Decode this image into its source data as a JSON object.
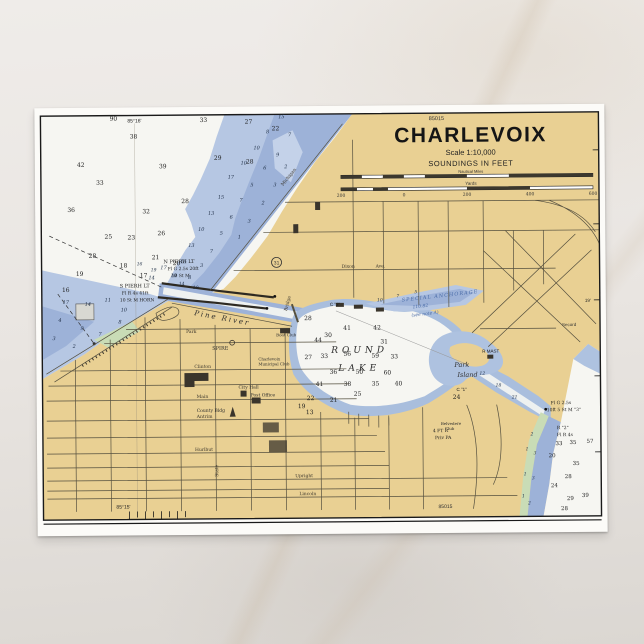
{
  "colors": {
    "land": "#e9d093",
    "water_light": "#b6c7e3",
    "water_mid": "#9db2d8",
    "water_deep_white": "#f6f6f2",
    "marsh_green": "#c9dcb6",
    "line": "#55503f",
    "anchorage_text": "#4a6ca8",
    "card": "#fcfbf8"
  },
  "title_block": {
    "chart_no": "85015",
    "title": "CHARLEVOIX",
    "scale": "Scale 1:10,000",
    "soundings": "SOUNDINGS IN FEET",
    "miles_label": "Nautical Miles",
    "yards_label": "Yards",
    "yards_ticks": [
      "200",
      "0",
      "200",
      "400",
      "600"
    ]
  },
  "borders": {
    "lon_top": "85°16'",
    "lon_bottom": "85°15'",
    "lat_right": "19'",
    "chart_no_bottom": "85015"
  },
  "features": {
    "round_lake_1": "ROUND",
    "round_lake_2": "LAKE",
    "pine_river": "Pine  River",
    "park_island_1": "Park",
    "park_island_2": "Island",
    "anchorage_1": "SPECIAL ANCHORAGE",
    "anchorage_2": "110.82",
    "anchorage_3": "(see note A)",
    "secord": "Secord"
  },
  "lights": {
    "n_pier_1": "N PIERH LT",
    "n_pier_2": "Fl G 2.5s 20ft",
    "n_pier_3": "10 St M",
    "s_pier_1": "S PIERH LT",
    "s_pier_2": "Fl R 4s 41ft",
    "s_pier_3": "10 St M HORN",
    "ch3_1": "Fl G 2.5s",
    "ch3_2": "10ft 5 St M \"3\"",
    "buoy2_1": "R \"2\"",
    "buoy2_2": "Fl R 4s",
    "priv_1": "4 FT R",
    "priv_2": "Priv PA",
    "r_mast": "R MAST",
    "c3": "C \"3\"",
    "c1": "C \"1\"",
    "us31": "31"
  },
  "places": {
    "spire": "SPIRE",
    "city_hall": "City Hall",
    "post_office": "Post Office",
    "county_bldg": "County Bldg",
    "municipal_1": "Charlevoix",
    "municipal_2": "Municipal Club",
    "boat_club": "Boat Club",
    "belvedere_1": "Belvedere",
    "belvedere_2": "Club"
  },
  "streets": {
    "dixon": "Dixon",
    "dixon_ave": "Ave.",
    "clinton": "Clinton",
    "main": "Main",
    "antrim": "Antrim",
    "hurlbut": "Hurlbut",
    "upright": "Upright",
    "lincoln": "Lincoln",
    "michigan": "Michigan",
    "state": "State",
    "bridge": "Bridge",
    "park": "Park"
  },
  "soundings": {
    "lm": {
      "size": 6,
      "fill": "#1e1e1e",
      "italic": false,
      "pts": [
        [
          79,
          13,
          "90"
        ],
        [
          169,
          15,
          "33"
        ],
        [
          214,
          17,
          "27"
        ],
        [
          241,
          24,
          "22"
        ],
        [
          99,
          31,
          "38"
        ],
        [
          46,
          59,
          "42"
        ],
        [
          128,
          61,
          "39"
        ],
        [
          183,
          53,
          "29"
        ],
        [
          215,
          57,
          "28"
        ],
        [
          65,
          77,
          "33"
        ],
        [
          36,
          104,
          "36"
        ],
        [
          111,
          106,
          "32"
        ],
        [
          150,
          96,
          "28"
        ],
        [
          73,
          131,
          "25"
        ],
        [
          96,
          132,
          "23"
        ],
        [
          126,
          128,
          "26"
        ],
        [
          57,
          150,
          "28"
        ],
        [
          120,
          152,
          "21"
        ],
        [
          141,
          158,
          "20"
        ],
        [
          44,
          168,
          "19"
        ],
        [
          88,
          160,
          "18"
        ],
        [
          108,
          170,
          "17"
        ],
        [
          30,
          184,
          "16"
        ]
      ]
    },
    "band": {
      "size": 5,
      "fill": "#1d2d45",
      "italic": true,
      "pts": [
        [
          247,
          12,
          "15"
        ],
        [
          233,
          27,
          "8"
        ],
        [
          255,
          30,
          "7"
        ],
        [
          222,
          43,
          "10"
        ],
        [
          243,
          50,
          "9"
        ],
        [
          209,
          58,
          "10"
        ],
        [
          230,
          63,
          "6"
        ],
        [
          251,
          62,
          "2"
        ],
        [
          196,
          72,
          "17"
        ],
        [
          217,
          80,
          "5"
        ],
        [
          240,
          80,
          "3"
        ],
        [
          186,
          92,
          "15"
        ],
        [
          206,
          95,
          "7"
        ],
        [
          228,
          98,
          "2"
        ],
        [
          176,
          108,
          "13"
        ],
        [
          196,
          112,
          "6"
        ],
        [
          214,
          116,
          "3"
        ],
        [
          166,
          124,
          "10"
        ],
        [
          186,
          128,
          "5"
        ],
        [
          204,
          132,
          "1"
        ],
        [
          156,
          140,
          "13"
        ],
        [
          176,
          146,
          "7"
        ],
        [
          148,
          156,
          "15"
        ],
        [
          166,
          160,
          "3"
        ],
        [
          138,
          170,
          "10"
        ],
        [
          154,
          172,
          "8"
        ],
        [
          128,
          162,
          "17"
        ],
        [
          116,
          172,
          "14"
        ]
      ]
    },
    "sw": {
      "size": 5,
      "fill": "#1d2d45",
      "italic": true,
      "pts": [
        [
          30,
          196,
          "17"
        ],
        [
          52,
          198,
          "14"
        ],
        [
          72,
          194,
          "11"
        ],
        [
          88,
          204,
          "10"
        ],
        [
          24,
          214,
          "4"
        ],
        [
          46,
          222,
          "9"
        ],
        [
          64,
          228,
          "7"
        ],
        [
          18,
          232,
          "3"
        ],
        [
          38,
          240,
          "2"
        ],
        [
          84,
          216,
          "8"
        ]
      ]
    },
    "channel": {
      "size": 4.5,
      "fill": "#1d2d45",
      "italic": true,
      "pts": [
        [
          146,
          178,
          "14"
        ],
        [
          160,
          182,
          "10"
        ],
        [
          118,
          164,
          "19"
        ],
        [
          104,
          158,
          "16"
        ]
      ]
    },
    "rl": {
      "size": 6,
      "fill": "#1e1e1e",
      "italic": false,
      "pts": [
        [
          272,
          214,
          "28"
        ],
        [
          292,
          231,
          "30"
        ],
        [
          282,
          236,
          "44"
        ],
        [
          311,
          224,
          "41"
        ],
        [
          341,
          224,
          "42"
        ],
        [
          348,
          238,
          "31"
        ],
        [
          272,
          253,
          "27"
        ],
        [
          288,
          252,
          "33"
        ],
        [
          311,
          250,
          "56"
        ],
        [
          339,
          252,
          "59"
        ],
        [
          358,
          253,
          "33"
        ],
        [
          297,
          268,
          "36"
        ],
        [
          323,
          268,
          "50"
        ],
        [
          351,
          269,
          "60"
        ],
        [
          283,
          280,
          "41"
        ],
        [
          311,
          280,
          "38"
        ],
        [
          339,
          280,
          "35"
        ],
        [
          321,
          290,
          "25"
        ],
        [
          297,
          296,
          "21"
        ],
        [
          274,
          294,
          "22"
        ],
        [
          265,
          302,
          "19"
        ],
        [
          273,
          308,
          "13"
        ],
        [
          362,
          280,
          "40"
        ],
        [
          420,
          294,
          "24"
        ]
      ]
    },
    "ne": {
      "size": 4.5,
      "fill": "#1d2d45",
      "italic": true,
      "pts": [
        [
          344,
          196,
          "10"
        ],
        [
          362,
          192,
          "7"
        ],
        [
          380,
          188,
          "5"
        ]
      ]
    },
    "se": {
      "size": 4.5,
      "fill": "#1d2d45",
      "italic": true,
      "pts": [
        [
          446,
          270,
          "12"
        ],
        [
          462,
          282,
          "18"
        ],
        [
          478,
          294,
          "21"
        ]
      ]
    },
    "lc": {
      "size": 5.5,
      "fill": "#1e1e1e",
      "italic": false,
      "pts": [
        [
          522,
          341,
          "33"
        ],
        [
          536,
          340,
          "35"
        ],
        [
          515,
          353,
          "20"
        ],
        [
          539,
          361,
          "35"
        ],
        [
          531,
          374,
          "28"
        ],
        [
          517,
          383,
          "24"
        ],
        [
          533,
          396,
          "29"
        ],
        [
          548,
          393,
          "39"
        ],
        [
          527,
          406,
          "28"
        ],
        [
          553,
          339,
          "57"
        ]
      ]
    },
    "lcs": {
      "size": 4.5,
      "fill": "#1d2d45",
      "italic": true,
      "pts": [
        [
          495,
          331,
          "2"
        ],
        [
          490,
          346,
          "1"
        ],
        [
          498,
          350,
          "3"
        ],
        [
          488,
          371,
          "1"
        ],
        [
          496,
          375,
          "3"
        ],
        [
          486,
          393,
          "1"
        ],
        [
          492,
          400,
          "2"
        ]
      ]
    }
  }
}
